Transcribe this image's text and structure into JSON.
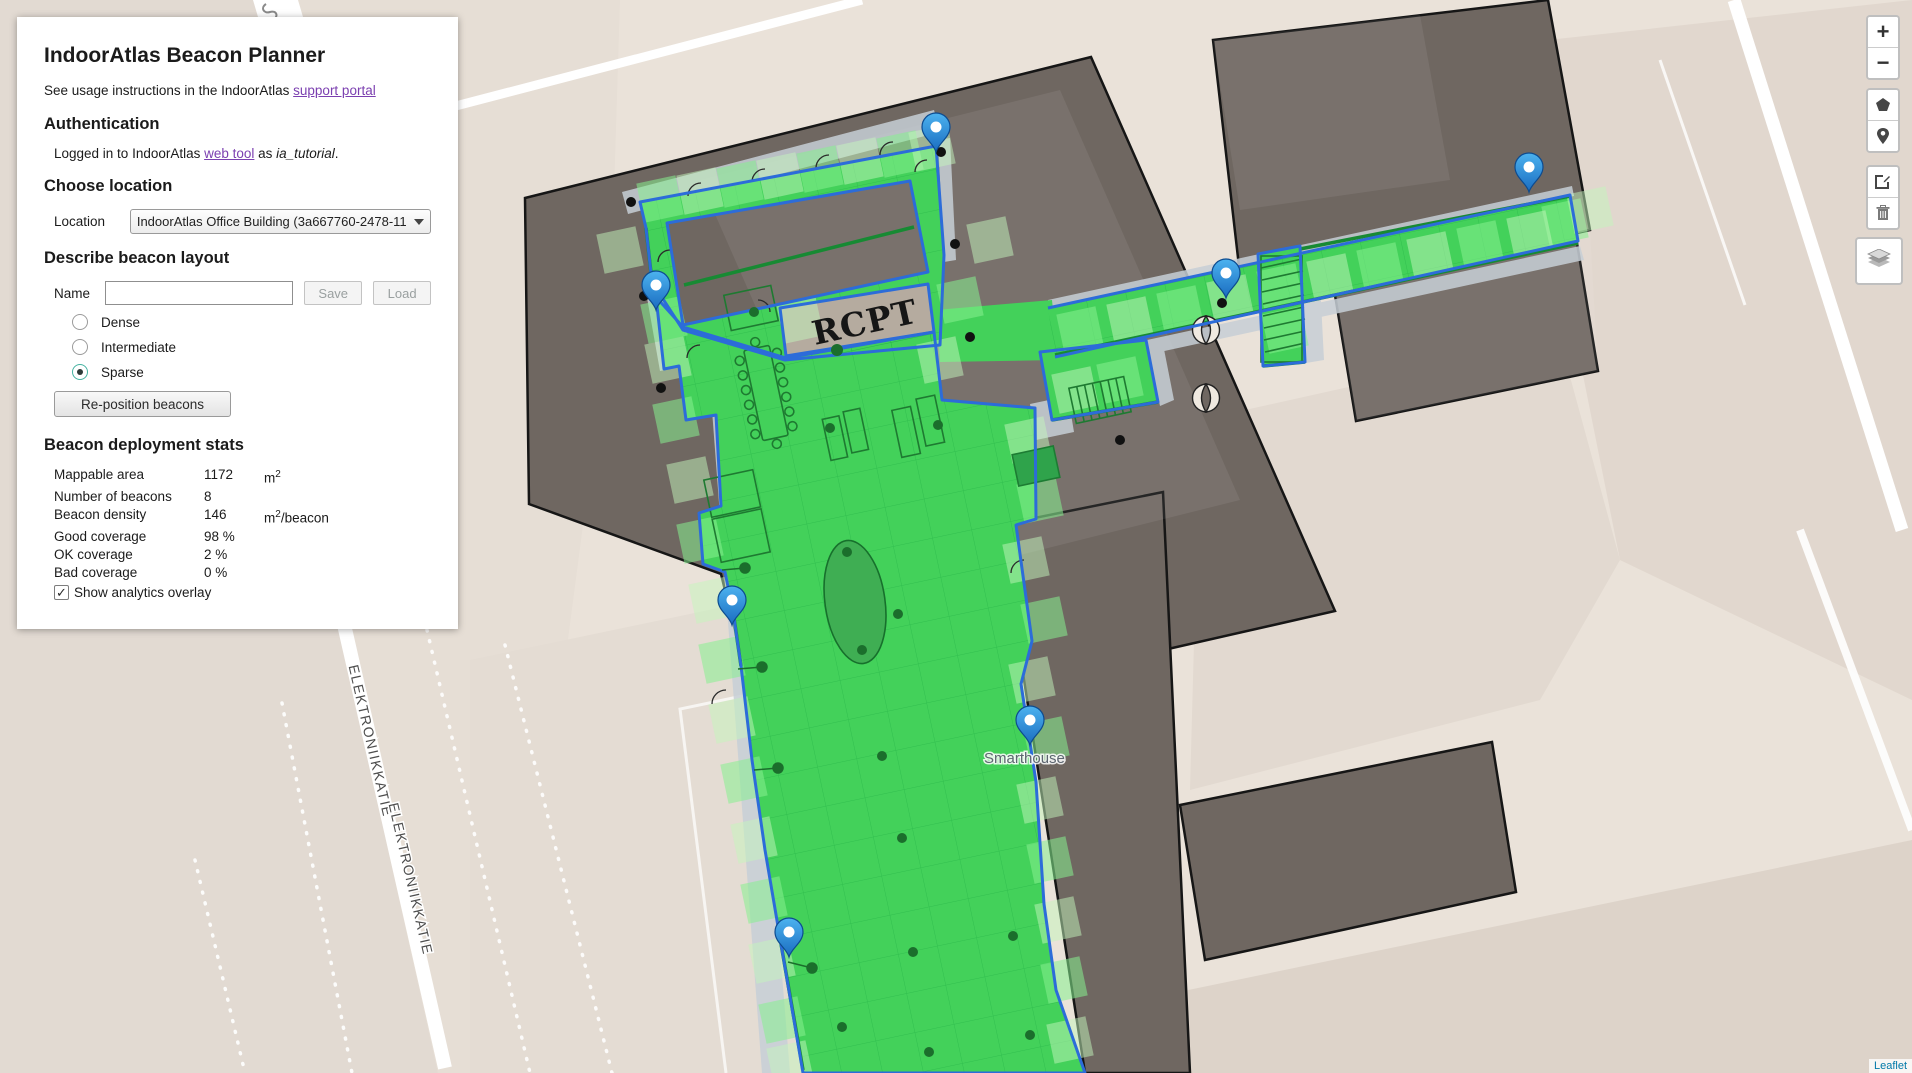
{
  "panel": {
    "title": "IndoorAtlas Beacon Planner",
    "usage_prefix": "See usage instructions in the IndoorAtlas ",
    "usage_link": "support portal",
    "auth_header": "Authentication",
    "login_prefix": "Logged in to IndoorAtlas ",
    "login_link": "web tool",
    "login_mid": " as ",
    "login_user": "ia_tutorial",
    "login_suffix": ".",
    "location_header": "Choose location",
    "location_label": "Location",
    "location_value": "IndoorAtlas Office Building (3a667760-2478-11",
    "layout_header": "Describe beacon layout",
    "name_label": "Name",
    "name_value": "",
    "save_label": "Save",
    "load_label": "Load",
    "radios": [
      {
        "label": "Dense"
      },
      {
        "label": "Intermediate"
      },
      {
        "label": "Sparse"
      }
    ],
    "selected_radio": "Sparse",
    "reposition_label": "Re-position beacons",
    "stats_header": "Beacon deployment stats",
    "stats": [
      {
        "label": "Mappable area",
        "value": "1172",
        "unit_base": "m",
        "unit_sup": "2",
        "unit_rest": ""
      },
      {
        "label": "Number of beacons",
        "value": "8",
        "unit_base": "",
        "unit_sup": "",
        "unit_rest": ""
      },
      {
        "label": "Beacon density",
        "value": "146",
        "unit_base": "m",
        "unit_sup": "2",
        "unit_rest": "/beacon"
      },
      {
        "label": "Good coverage",
        "value": "98 %",
        "unit_base": "",
        "unit_sup": "",
        "unit_rest": ""
      },
      {
        "label": "OK coverage",
        "value": "2 %",
        "unit_base": "",
        "unit_sup": "",
        "unit_rest": ""
      },
      {
        "label": "Bad coverage",
        "value": "0 %",
        "unit_base": "",
        "unit_sup": "",
        "unit_rest": ""
      }
    ],
    "overlay_checkbox_label": "Show analytics overlay",
    "overlay_checked": "✓"
  },
  "map": {
    "rcpt_label": "RCPT",
    "smarthouse_label": "Smarthouse",
    "street_label_1": "ELEKTRONIIKKATIE",
    "street_label_2": "ELEKTRONIIKKATIE",
    "beacon_count": 8,
    "attribution_link": "Leaflet"
  },
  "controls": {
    "zoom_in": "+",
    "zoom_out": "−",
    "icon_names": [
      "draw-polygon",
      "add-beacon",
      "edit-layers",
      "delete-layers",
      "layers"
    ]
  },
  "colors": {
    "coverage_green": "#43d15a",
    "outline_blue": "#2c6cd9",
    "building_gray": "#6f6761",
    "pin_blue": "#2f9de3",
    "link_purple": "#7b3fb0",
    "attribution_blue": "#0078A8"
  }
}
